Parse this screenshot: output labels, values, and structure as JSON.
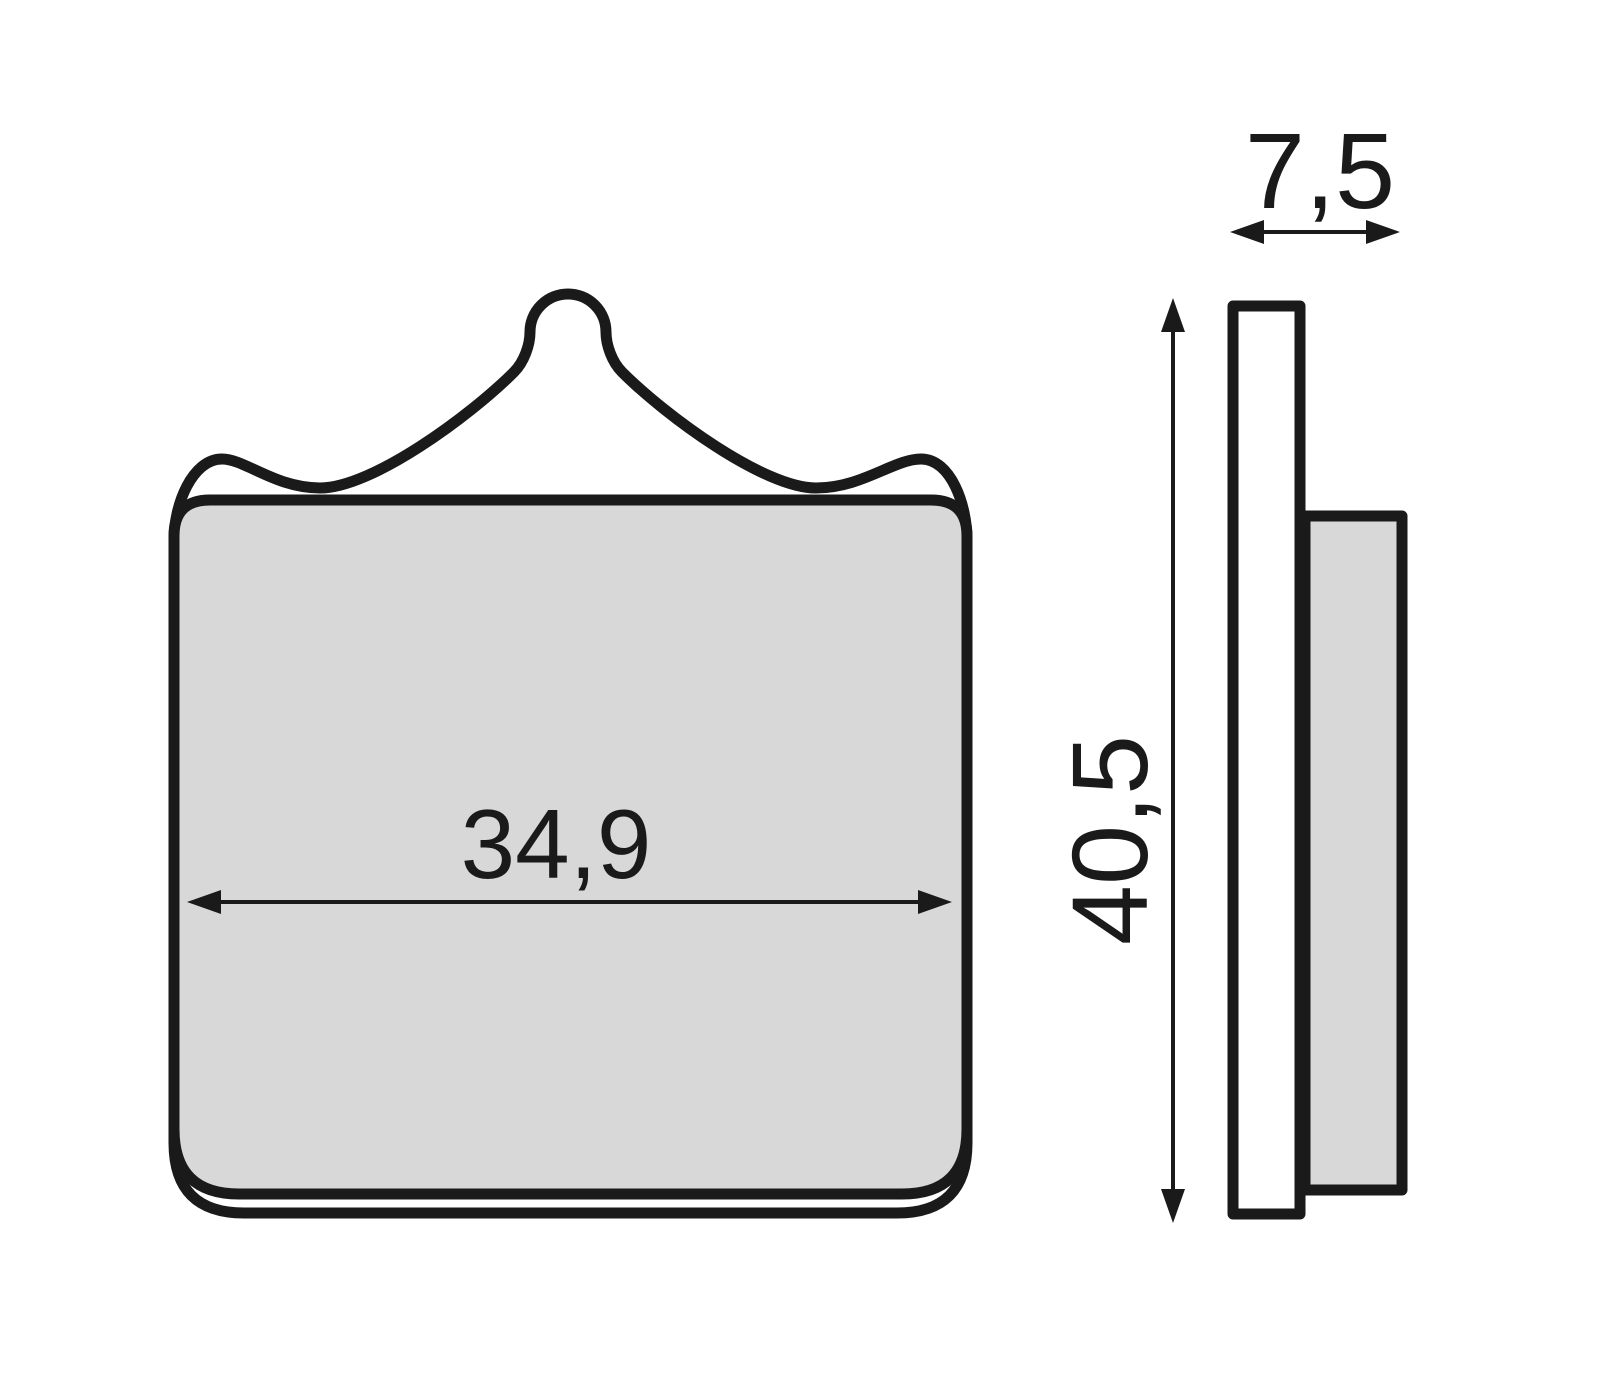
{
  "diagram": {
    "subject": "brake-pad-dimension-drawing",
    "front_view": {
      "width_label": "34,9"
    },
    "side_view": {
      "thickness_label": "7,5",
      "height_label": "40,5"
    },
    "colors": {
      "line": "#1a1a1a",
      "pad_fill": "#d8d8d8",
      "plate_fill": "#ffffff",
      "background": "#ffffff"
    }
  }
}
